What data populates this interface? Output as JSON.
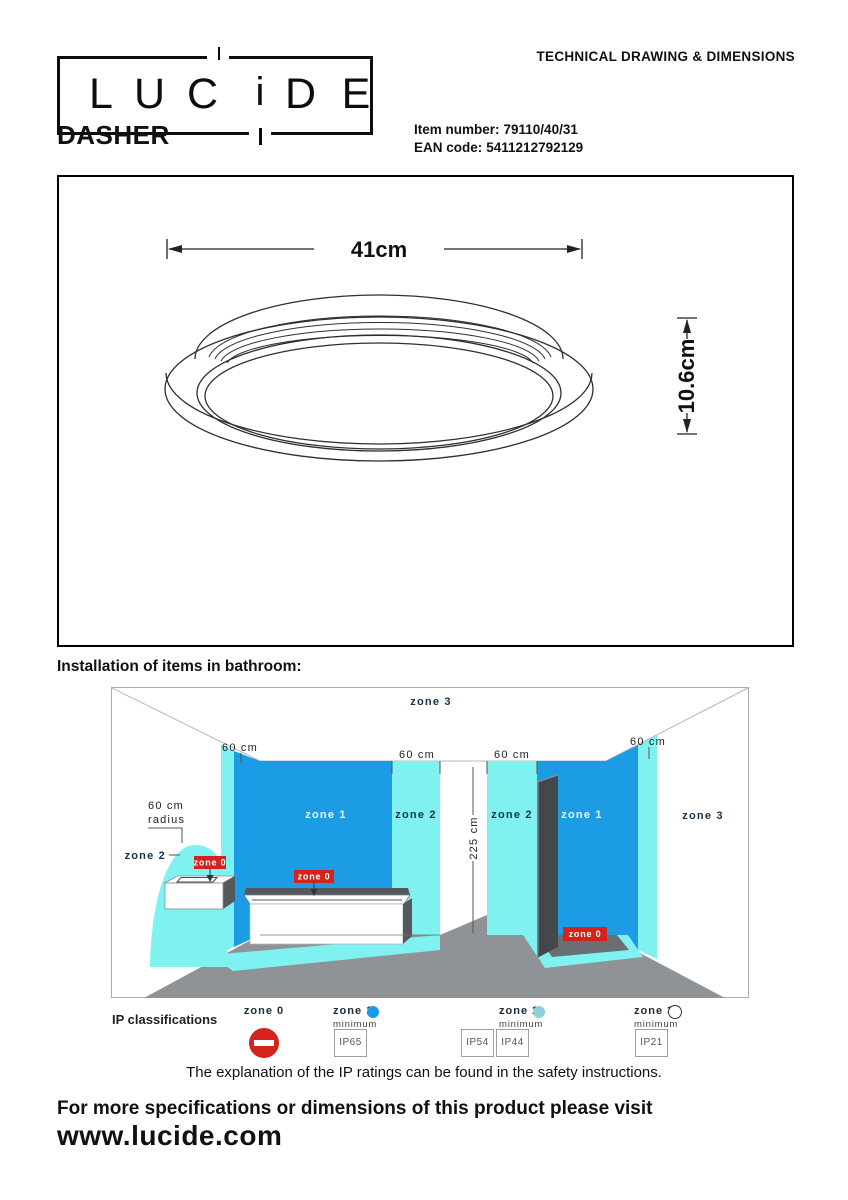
{
  "header": {
    "logo_letters": [
      "L",
      "U",
      "C",
      "i",
      "D",
      "E"
    ],
    "doc_title": "TECHNICAL DRAWING & DIMENSIONS",
    "product_name": "DASHER",
    "item_number_label": "Item number:",
    "item_number_value": "79110/40/31",
    "ean_label": "EAN code:",
    "ean_value": "5411212792129"
  },
  "technical_drawing": {
    "width_dimension": "41cm",
    "height_dimension": "10.6cm"
  },
  "bathroom_diagram": {
    "title": "Installation of items in bathroom:",
    "zone3_ceiling_label": "zone 3",
    "zone3_wall_label": "zone 3",
    "zone1_tub_label": "zone 1",
    "zone2_tub_label": "zone 2",
    "zone2_shower_label": "zone 2",
    "zone1_shower_label": "zone 1",
    "zone2_basin_label": "zone 2",
    "zone0_badge": "zone 0",
    "dim_60cm": "60 cm",
    "dim_60cm_radius_line1": "60 cm",
    "dim_60cm_radius_line2": "radius",
    "dim_225cm": "225 cm"
  },
  "ip_legend": {
    "title": "IP classifications",
    "zones": [
      {
        "label": "zone 0",
        "minimum_label": "",
        "ratings": []
      },
      {
        "label": "zone 1",
        "minimum_label": "minimum",
        "ratings": [
          "IP65"
        ]
      },
      {
        "label": "zone 2",
        "minimum_label": "minimum",
        "ratings": [
          "IP54",
          "IP44"
        ]
      },
      {
        "label": "zone 3",
        "minimum_label": "minimum",
        "ratings": [
          "IP21"
        ]
      }
    ],
    "note": "The explanation of the IP ratings can be found in the safety instructions."
  },
  "footer": {
    "line1": "For more specifications or dimensions of this product please visit",
    "website": "www.lucide.com"
  },
  "colors": {
    "zone1_blue": "#1b9ce4",
    "zone2_cyan": "#7ff1f0",
    "zone0_red": "#d6221c",
    "floor_gray": "#8f9296",
    "panel_dark": "#44474c"
  }
}
